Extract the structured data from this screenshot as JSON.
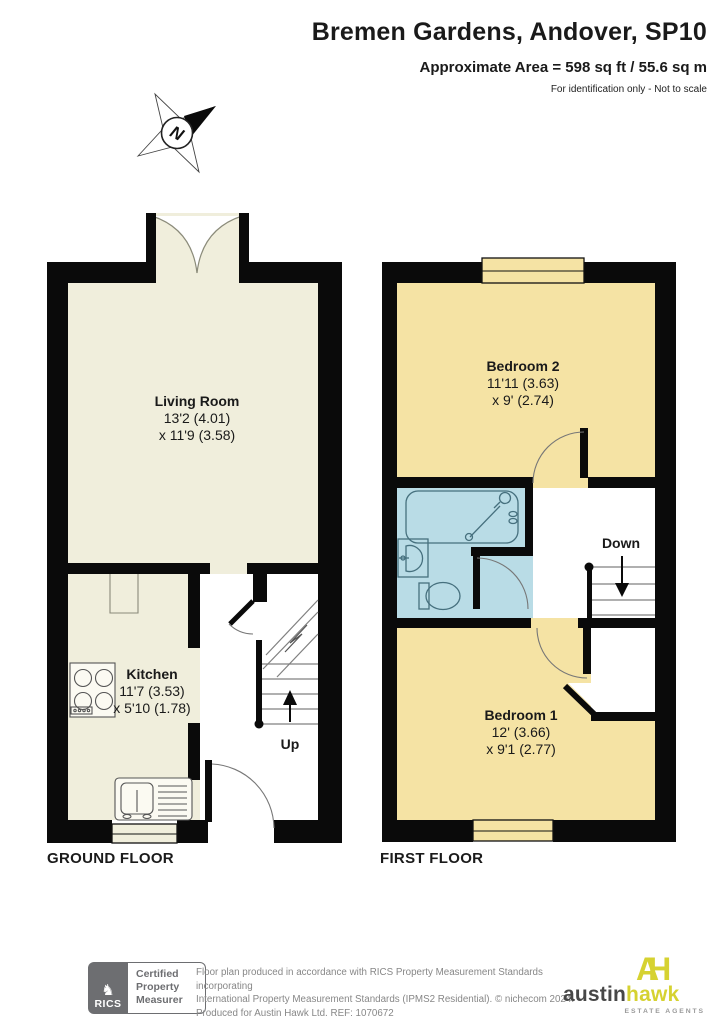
{
  "header": {
    "title": "Bremen Gardens, Andover, SP10",
    "area": "Approximate Area = 598 sq ft / 55.6 sq m",
    "note": "For identification only - Not to scale"
  },
  "compass": {
    "label": "N"
  },
  "ground_floor": {
    "label": "GROUND FLOOR",
    "living_room": {
      "name": "Living Room",
      "dim1": "13'2 (4.01)",
      "dim2": "x 11'9 (3.58)"
    },
    "kitchen": {
      "name": "Kitchen",
      "dim1": "11'7 (3.53)",
      "dim2": "x 5'10 (1.78)"
    },
    "stairs_label": "Up"
  },
  "first_floor": {
    "label": "FIRST FLOOR",
    "bedroom2": {
      "name": "Bedroom 2",
      "dim1": "11'11 (3.63)",
      "dim2": "x 9' (2.74)"
    },
    "bedroom1": {
      "name": "Bedroom 1",
      "dim1": "12' (3.66)",
      "dim2": "x 9'1 (2.77)"
    },
    "stairs_label": "Down"
  },
  "footer": {
    "rics_brand": "RICS",
    "rics_badge": [
      "Certified",
      "Property",
      "Measurer"
    ],
    "disclaimer": [
      "Floor plan produced in accordance with RICS Property Measurement Standards incorporating",
      "International Property Measurement Standards (IPMS2 Residential).   © nichecom 2024.",
      "Produced for Austin Hawk Ltd.   REF: 1070672"
    ],
    "agent": {
      "monogram_a": "A",
      "monogram_h": "H",
      "name_austin": "austin",
      "name_hawk": "hawk",
      "tagline": "ESTATE AGENTS"
    }
  },
  "colors": {
    "room_cream": "#f0eedc",
    "room_yellow": "#f5e3a4",
    "bathroom_blue": "#b9dce6",
    "wall": "#0a0a0a",
    "agent_yellow": "#d6d231",
    "rics_grey": "#6d6e71"
  }
}
